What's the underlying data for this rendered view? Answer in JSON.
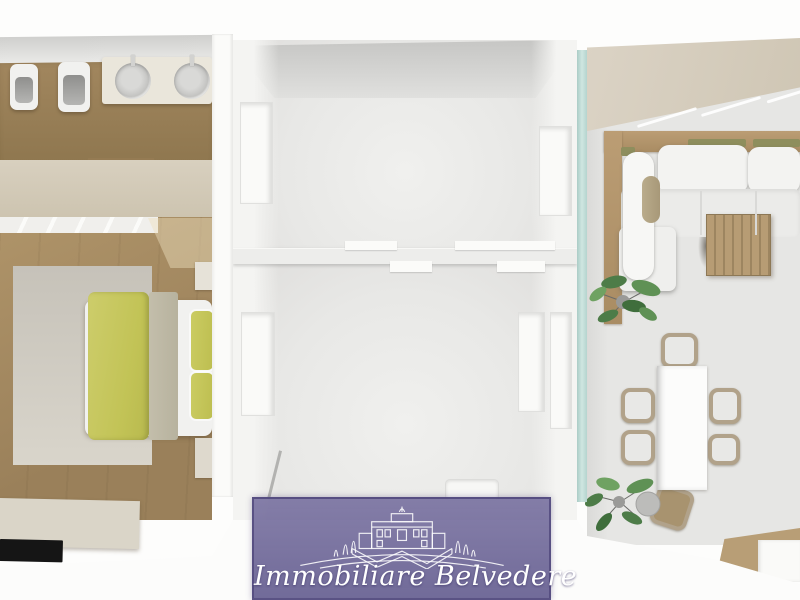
{
  "watermark": {
    "agency_name": "Immobiliare Belvedere",
    "logo": "villa-with-cypresses-line-art",
    "banner_color": "#6e6899",
    "text_color": "#ffffff"
  },
  "floor_plan": {
    "view": "top-down 3D render of an apartment",
    "palette": {
      "wood_floor": "#a0865e",
      "beige_wall": "#d3cab8",
      "gray_room_floor": "#e9e9e7",
      "glass_partition": "#bdd8d2",
      "sofa_wood": "#b2946c",
      "duvet_yellow": "#c4c558",
      "rug_gray": "#cfcbc2",
      "plant_green": "#55844f",
      "tv_black": "#151515",
      "chair_wicker": "#b1a28a",
      "banner_purple": "#6e6899"
    },
    "rooms": {
      "bathroom": {
        "position": "top-left",
        "fixtures": [
          "bidet",
          "toilet",
          "double-sink-counter"
        ]
      },
      "bedroom": {
        "position": "left",
        "furniture": [
          "double-bed",
          "yellow-duvet",
          "pillows",
          "rug",
          "nightstand",
          "dresser",
          "tv-sideboard",
          "tv"
        ]
      },
      "central_room_upper": {
        "position": "center-top",
        "furniture": []
      },
      "central_room_lower": {
        "position": "center-bottom",
        "furniture": [
          "shower-tray",
          "handrail"
        ]
      },
      "living_room": {
        "position": "right",
        "furniture": [
          "corner-sofa",
          "coffee-table",
          "dining-table",
          "plants"
        ],
        "dining_chairs": 6,
        "plants": 2
      }
    }
  }
}
